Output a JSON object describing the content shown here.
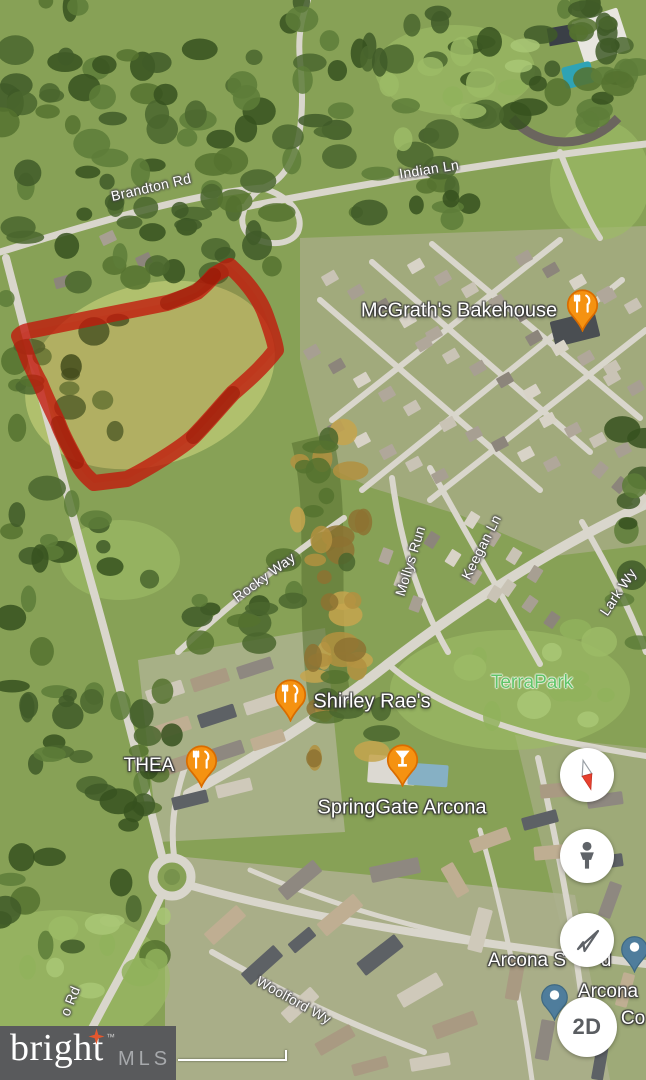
{
  "roads": {
    "brandton": "Brandton Rd",
    "indian": "Indian Ln",
    "rocky": "Rocky Way",
    "mollys": "Mollys Run",
    "keegan": "Keegan Ln",
    "lark": "Lark Wy",
    "woolford": "Woolford Wy",
    "west_rd_partial": "o Rd"
  },
  "pois": {
    "mcgraths": "McGrath's Bakehouse",
    "shirley": "Shirley Rae's",
    "thea": "THEA",
    "springgate": "SpringGate Arcona",
    "terrapark": "TerraPark",
    "arcona_partial_left": "Arcona S",
    "arcona_partial_right": "d",
    "arcona2_line1": "Arcona",
    "arcona2_line2": "Co"
  },
  "controls": {
    "view_2d": "2D"
  },
  "watermark": {
    "brand": "bright",
    "tm": "™",
    "suffix": "MLS"
  },
  "colors": {
    "parcel_red": "#c2170a",
    "pin_orange_top": "#fba821",
    "pin_orange_bottom": "#ef7d00",
    "pin_orange_border": "#d96c00",
    "pin_blue": "#4f7d9c",
    "park_label_green": "#5fc468",
    "logo_bg_gray": "#595a5c",
    "logo_star_orange": "#e4572e"
  }
}
